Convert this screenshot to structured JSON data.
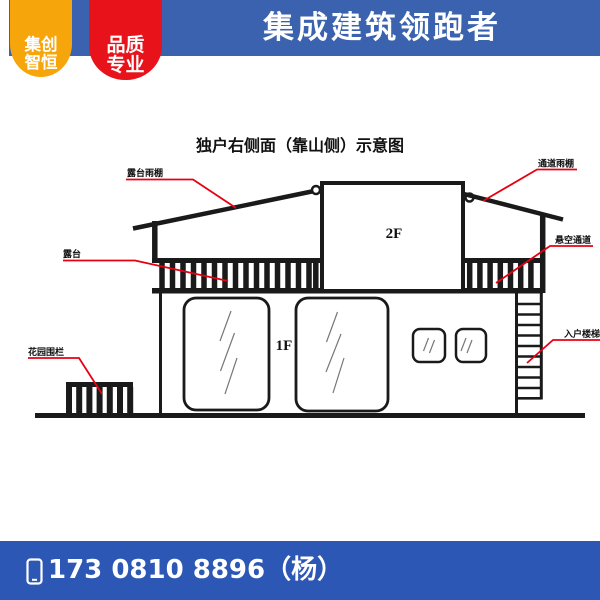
{
  "header": {
    "bar_color": "#3A62AF",
    "badge_primary": {
      "bg_color": "#F6A50A",
      "line1": "集创",
      "line2": "智恒"
    },
    "badge_secondary": {
      "bg_color": "#E8121A",
      "line1": "品质",
      "line2": "专业"
    },
    "title": "集成建筑领跑者"
  },
  "diagram": {
    "title": "独户右侧面（靠山侧）示意图",
    "floor_labels": {
      "second": "2F",
      "first": "1F"
    },
    "callouts": {
      "terrace_canopy": "露台雨棚",
      "terrace": "露台",
      "garden_fence": "花园围栏",
      "passage_canopy": "通道雨棚",
      "suspended_passage": "悬空通道",
      "entry_stairs": "入户楼梯"
    },
    "line_color": "#1A1A1A",
    "callout_line_color": "#E60012"
  },
  "footer": {
    "bar_color": "#2C57B5",
    "phone_icon": "mobile-phone-icon",
    "phone": "173 0810 8896（杨）"
  }
}
